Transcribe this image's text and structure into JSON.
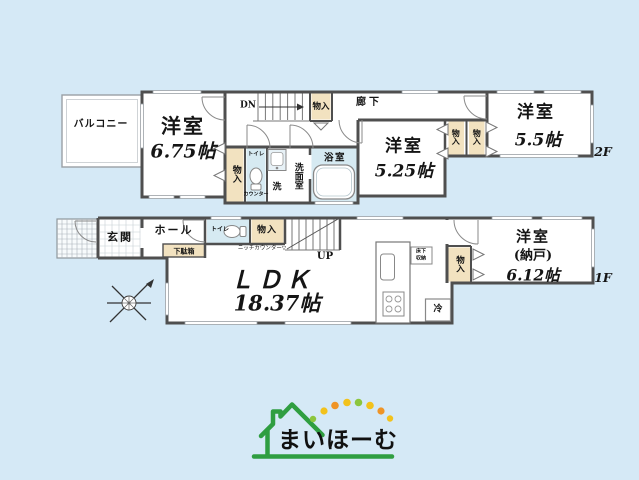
{
  "colors": {
    "background": "#d5e9f6",
    "wall": "#4f4f4f",
    "closet_fill": "#f2e2c0",
    "wet_room_fill": "#d6eaf2",
    "logo_green": "#2f9e41",
    "dot_yellow": "#f2c21c",
    "dot_orange": "#ef9426",
    "dot_green": "#8cc63e"
  },
  "floor2": {
    "floor_label": "2F",
    "balcony_label": "バルコニー",
    "room_675_name": "洋室",
    "room_675_size": "6.75帖",
    "stairs_label": "DN",
    "closet_top_label": "物入",
    "hallway_label": "廊下",
    "closet_left_label": "物入",
    "toilet_label": "トイレ",
    "toilet_counter_label": "カウンター",
    "washer_label": "洗",
    "washroom_label": "洗面室",
    "bath_label": "浴室",
    "room_525_name": "洋室",
    "room_525_size": "5.25帖",
    "closet_a_label": "物入",
    "closet_b_label": "物入",
    "room_55_name": "洋室",
    "room_55_size": "5.5帖"
  },
  "floor1": {
    "floor_label": "1F",
    "entrance_label": "玄関",
    "hall_label": "ホール",
    "shoebox_label": "下駄箱",
    "toilet_label": "トイレ",
    "closet_top_label": "物入",
    "niche_counter_label": "ニッチカウンター▽",
    "stairs_label": "UP",
    "ldk_name": "ＬＤＫ",
    "ldk_size": "18.37帖",
    "underfloor_line1": "床下",
    "underfloor_line2": "収納",
    "fridge_label": "冷",
    "closet_right_label": "物入",
    "storage_room_name": "洋室",
    "storage_room_sub": "(納戸)",
    "storage_room_size": "6.12帖"
  },
  "logo": {
    "text": "まいほーむ"
  }
}
